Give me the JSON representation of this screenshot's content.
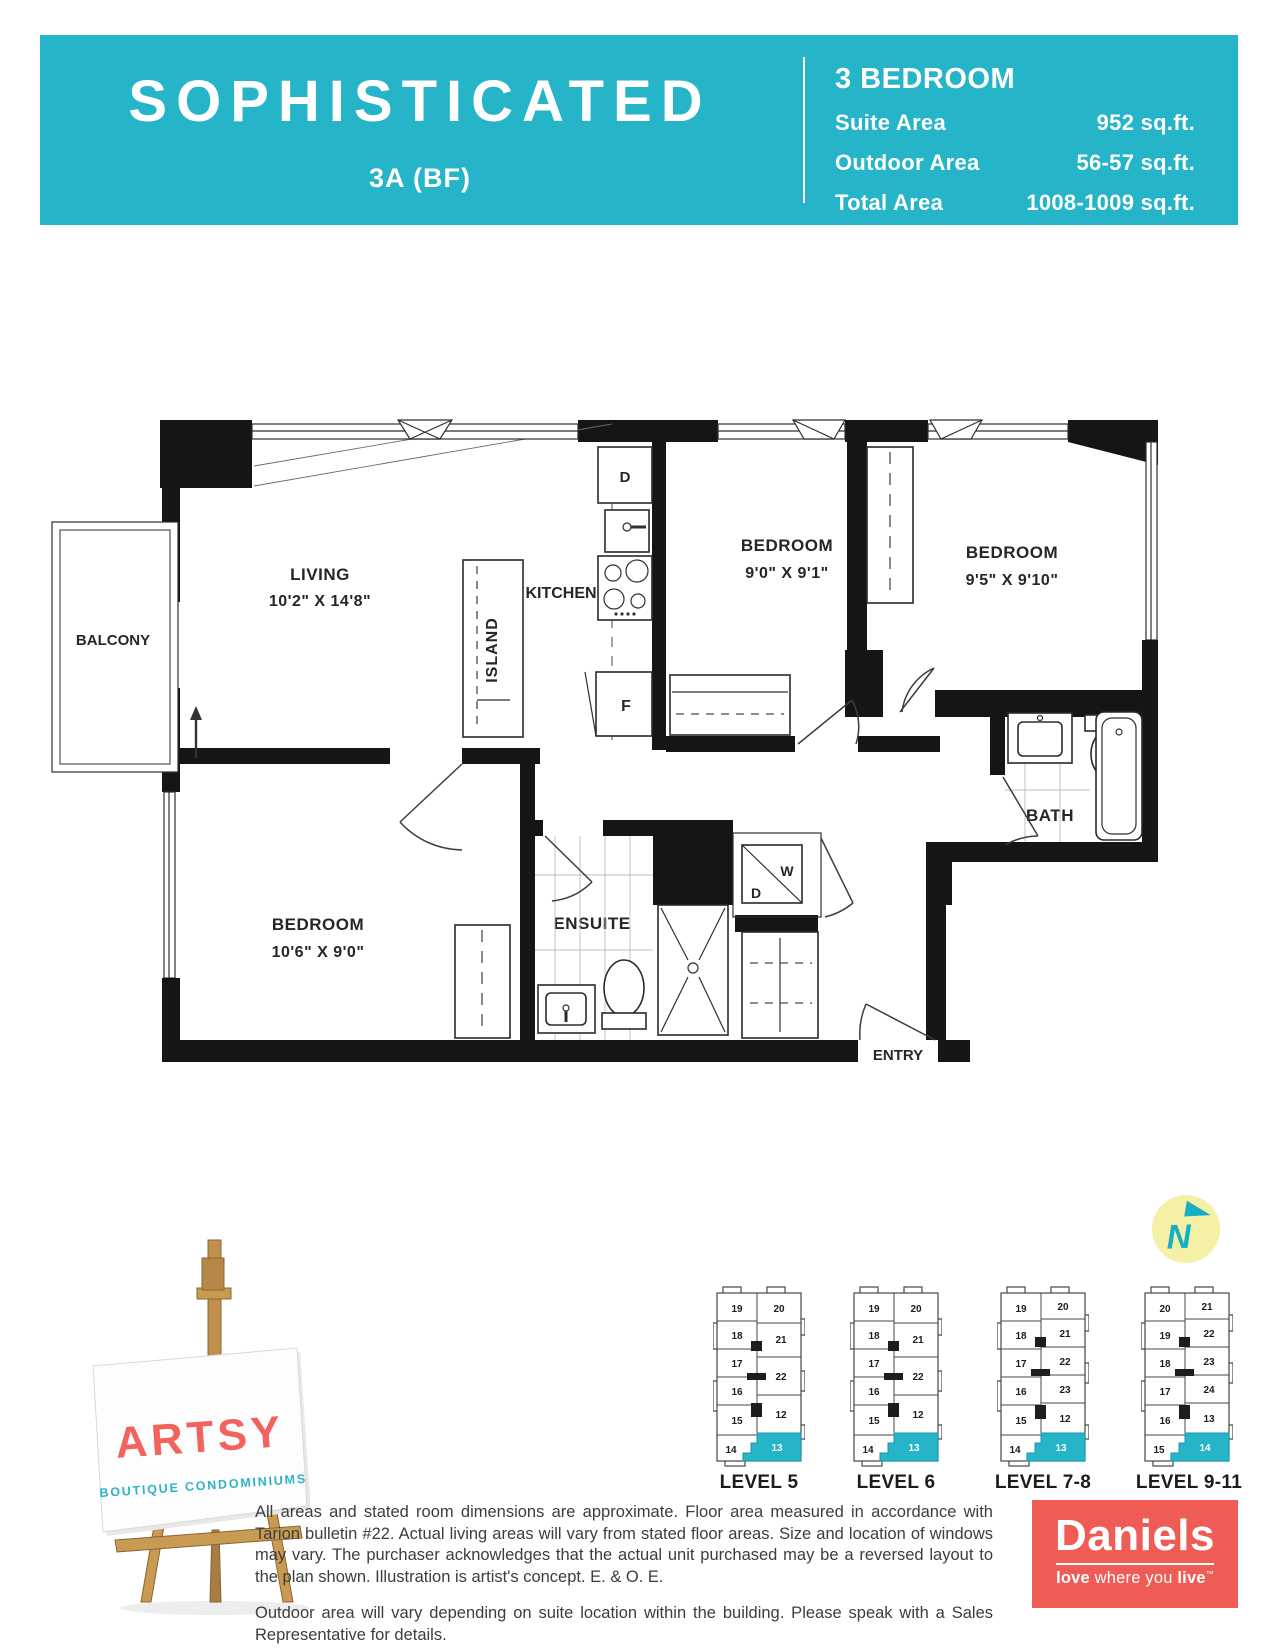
{
  "colors": {
    "teal": "#25b4c8",
    "daniels_red": "#ef5b55",
    "artsy_red": "#f2635e",
    "compass_yellow": "#f4f1a6",
    "wall_black": "#151515"
  },
  "header": {
    "title": "SOPHISTICATED",
    "subtitle": "3A (BF)",
    "plan_type": "3 BEDROOM",
    "stats": [
      {
        "label": "Suite Area",
        "value": "952 sq.ft."
      },
      {
        "label": "Outdoor Area",
        "value": "56-57 sq.ft."
      },
      {
        "label": "Total Area",
        "value": "1008-1009 sq.ft."
      }
    ]
  },
  "floorplan": {
    "balcony": "BALCONY",
    "living": {
      "name": "LIVING",
      "dims": "10'2\" X 14'8\""
    },
    "kitchen": {
      "label": "KITCHEN",
      "island": "ISLAND",
      "dishwasher": "D",
      "fridge": "F"
    },
    "bedroom1": {
      "name": "BEDROOM",
      "dims": "9'0\" X 9'1\""
    },
    "bedroom2": {
      "name": "BEDROOM",
      "dims": "9'5\" X 9'10\""
    },
    "bedroom3": {
      "name": "BEDROOM",
      "dims": "10'6\" X 9'0\""
    },
    "ensuite": "ENSUITE",
    "bath": "BATH",
    "entry": "ENTRY",
    "laundry": {
      "washer": "W",
      "dryer": "D"
    }
  },
  "compass": {
    "label": "N"
  },
  "logo": {
    "brand": "ARTSY",
    "tagline": "BOUTIQUE CONDOMINIUMS"
  },
  "keyplans": [
    {
      "label": "LEVEL 5",
      "left": [
        "19",
        "18",
        "17",
        "16",
        "15",
        "14"
      ],
      "right": [
        "20",
        "21",
        "22",
        "12"
      ],
      "highlight": "13"
    },
    {
      "label": "LEVEL 6",
      "left": [
        "19",
        "18",
        "17",
        "16",
        "15",
        "14"
      ],
      "right": [
        "20",
        "21",
        "22",
        "12"
      ],
      "highlight": "13"
    },
    {
      "label": "LEVEL 7-8",
      "left": [
        "19",
        "18",
        "17",
        "16",
        "15",
        "14"
      ],
      "right": [
        "20",
        "21",
        "22",
        "23",
        "12"
      ],
      "highlight": "13"
    },
    {
      "label": "LEVEL 9-11",
      "left": [
        "20",
        "19",
        "18",
        "17",
        "16",
        "15"
      ],
      "right": [
        "21",
        "22",
        "23",
        "24",
        "13"
      ],
      "highlight": "14"
    }
  ],
  "disclaimer": {
    "p1": "All areas and stated room dimensions are approximate. Floor area measured in accordance with Tarion bulletin #22. Actual living areas will vary from stated floor areas. Size and location of windows may vary. The purchaser acknowledges that the actual unit purchased may be a reversed layout to the plan shown. Illustration is artist's concept. E. & O. E.",
    "p2": "Outdoor area will vary depending on suite location within the building. Please speak with a Sales Representative for details."
  },
  "developer": {
    "name": "Daniels",
    "tag_bold1": "love",
    "tag_mid": " where you ",
    "tag_bold2": "live",
    "tm": "™"
  }
}
